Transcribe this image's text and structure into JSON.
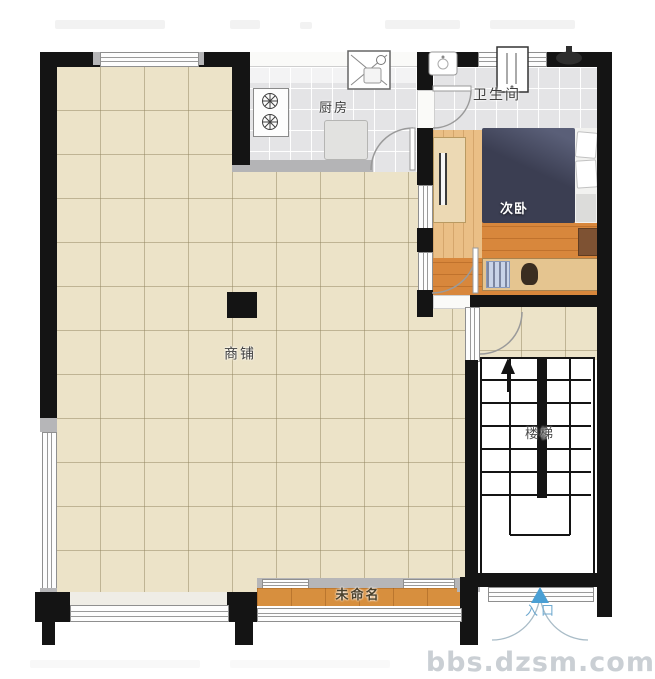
{
  "rooms": {
    "kitchen": "厨房",
    "bathroom": "卫生间",
    "bedroom": "次卧",
    "shop": "商铺",
    "stairs": "楼梯",
    "unnamed": "未命名",
    "entrance": "入口"
  },
  "watermark": "bbs.dzsm.com",
  "colors": {
    "wall": "#141414",
    "shop_floor": "#ece3c8",
    "tile_floor": "#e4e4e6",
    "wood_floor": "#d8873c",
    "bed": "#3b3e52",
    "entrance_arrow": "#4a9fd4",
    "watermark": "#cacfd4"
  }
}
